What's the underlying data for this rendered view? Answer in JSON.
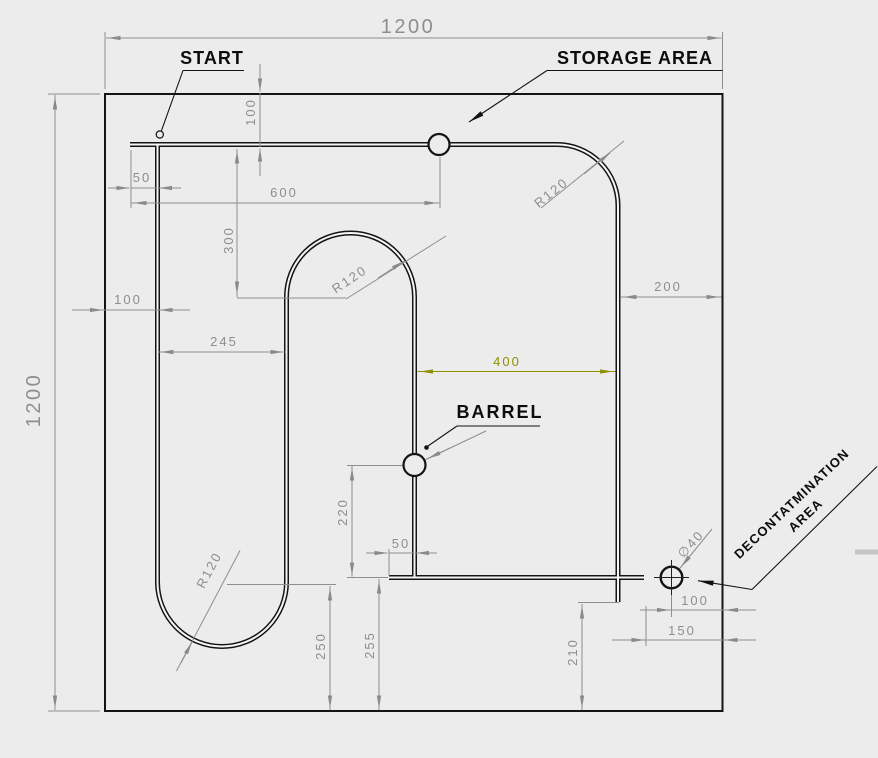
{
  "labels": {
    "start": "START",
    "storage_area": "STORAGE AREA",
    "barrel": "BARREL",
    "decontamination_line1": "DECONTATMINATION",
    "decontamination_line2": "AREA"
  },
  "dimensions": {
    "sheet_width": "1200",
    "sheet_height": "1200",
    "track_top_offset": "100",
    "start_overhang": "50",
    "storage_from_start": "600",
    "arch_center_drop": "300",
    "track_left_margin": "100",
    "arch_left_offset": "245",
    "corridor_width": "400",
    "track_right_margin": "200",
    "corner_radius": "R120",
    "arch_radius": "R120",
    "uturn_radius": "R120",
    "barrel_circle_radius": "R20",
    "barrel_to_bottom_line": "220",
    "bottom_stub": "50",
    "bottom_line_height": "255",
    "uturn_center_height": "250",
    "tail_end_height": "210",
    "decon_offset_circle": "100",
    "decon_offset_wall": "150",
    "decon_diameter": "∅40"
  },
  "colors": {
    "background": "#ececec",
    "line": "#141414",
    "dimension": "#8e8e8e",
    "highlight_dimension": "#8f8f00"
  }
}
